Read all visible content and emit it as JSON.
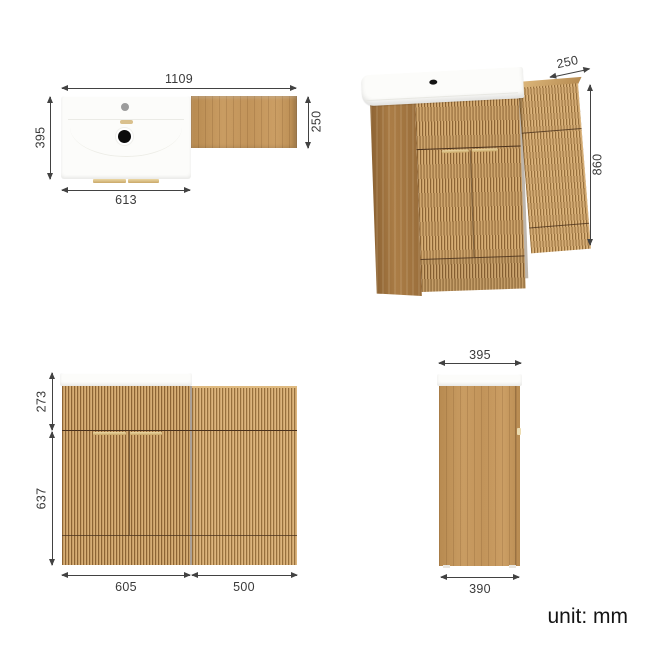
{
  "meta": {
    "unit_label": "unit: mm"
  },
  "colors": {
    "wood_light": "#d6ae76",
    "wood_mid": "#c89e66",
    "wood_dark": "#8c6434",
    "wood_side": "#a87c46",
    "gold_handle": "#caa868",
    "dimension_line": "#424242",
    "sink_white": "#fcfcfa"
  },
  "views": {
    "top": {
      "title": "top view",
      "dims": {
        "overall_width": "1109",
        "basin_depth": "395",
        "wc_depth": "250",
        "basin_width": "613"
      }
    },
    "perspective": {
      "title": "perspective view",
      "dims": {
        "depth": "250",
        "height": "860"
      }
    },
    "front": {
      "title": "front view",
      "dims": {
        "upper_height": "273",
        "lower_height": "637",
        "vanity_width": "605",
        "wc_width": "500"
      }
    },
    "side": {
      "title": "side view",
      "dims": {
        "top_depth": "395",
        "bottom_depth": "390"
      }
    }
  }
}
